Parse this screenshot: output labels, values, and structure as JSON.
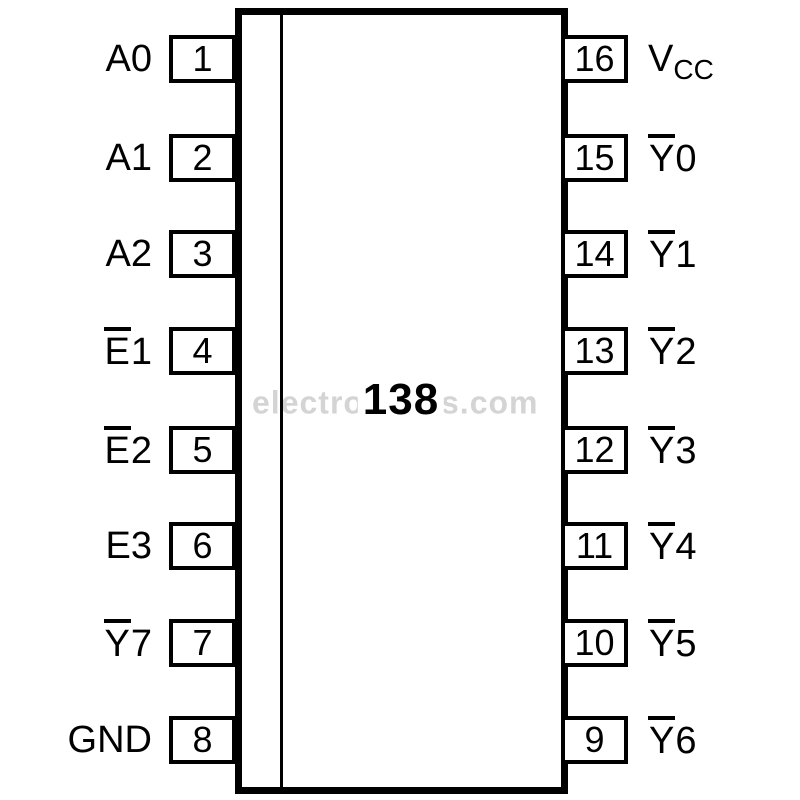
{
  "chip": {
    "label": "138"
  },
  "watermark": {
    "left": "electro",
    "right": "s.com"
  },
  "pins": {
    "left": [
      {
        "number": "1",
        "name": "A0",
        "overbar": false
      },
      {
        "number": "2",
        "name": "A1",
        "overbar": false
      },
      {
        "number": "3",
        "name": "A2",
        "overbar": false
      },
      {
        "number": "4",
        "name": "E1",
        "overbar": true
      },
      {
        "number": "5",
        "name": "E2",
        "overbar": true
      },
      {
        "number": "6",
        "name": "E3",
        "overbar": false
      },
      {
        "number": "7",
        "name": "Y7",
        "overbar": true
      },
      {
        "number": "8",
        "name": "GND",
        "overbar": false
      }
    ],
    "right": [
      {
        "number": "16",
        "name": "V",
        "sub": "CC",
        "overbar": false
      },
      {
        "number": "15",
        "name": "Y0",
        "overbar": true
      },
      {
        "number": "14",
        "name": "Y1",
        "overbar": true
      },
      {
        "number": "13",
        "name": "Y2",
        "overbar": true
      },
      {
        "number": "12",
        "name": "Y3",
        "overbar": true
      },
      {
        "number": "11",
        "name": "Y4",
        "overbar": true
      },
      {
        "number": "10",
        "name": "Y5",
        "overbar": true
      },
      {
        "number": "9",
        "name": "Y6",
        "overbar": true
      }
    ]
  },
  "colors": {
    "ink": "#000000",
    "watermark": "#d4d4d4",
    "background": "#ffffff"
  }
}
